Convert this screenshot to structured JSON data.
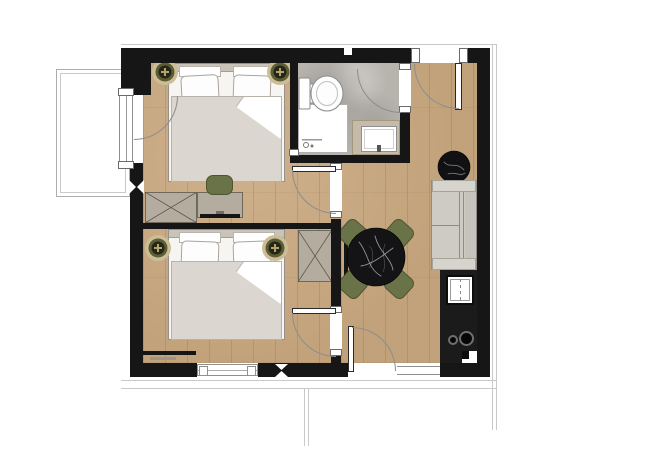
{
  "plan": {
    "kind": "apartment-floor-plan",
    "rooms": [
      {
        "name": "bedroom-1",
        "position": "top-left"
      },
      {
        "name": "bedroom-2",
        "position": "bottom-left"
      },
      {
        "name": "bathroom",
        "position": "top-center"
      },
      {
        "name": "living-kitchen",
        "position": "right"
      },
      {
        "name": "balcony",
        "position": "outside-left"
      }
    ],
    "fixtures": [
      {
        "icon": "double-bed-icon",
        "count": 2
      },
      {
        "icon": "nightstand-lamp-icon",
        "count": 4
      },
      {
        "icon": "wardrobe-x-icon",
        "count": 2
      },
      {
        "icon": "desk-icon",
        "count": 1
      },
      {
        "icon": "tv-icon",
        "count": 3
      },
      {
        "icon": "desk-chair-icon",
        "count": 1
      },
      {
        "icon": "toilet-icon",
        "count": 1
      },
      {
        "icon": "shower-icon",
        "count": 1
      },
      {
        "icon": "vanity-sink-icon",
        "count": 1
      },
      {
        "icon": "sofa-icon",
        "count": 1
      },
      {
        "icon": "kitchen-sink-icon",
        "count": 1
      },
      {
        "icon": "cooktop-icon",
        "count": 1
      },
      {
        "icon": "round-dining-table-icon",
        "count": 1
      },
      {
        "icon": "dining-chair-icon",
        "count": 4
      },
      {
        "icon": "side-table-icon",
        "count": 1
      },
      {
        "icon": "door-swing-arc",
        "count": 6
      },
      {
        "icon": "window",
        "count": 3
      }
    ],
    "palette": {
      "wall": "#161616",
      "wood": "#c9a87f",
      "bath_floor": "#b7b4ae",
      "furniture": "#b4ac9e",
      "furniture_border": "#6f685c",
      "sofa": "#cecbc4",
      "green": "#6a7347",
      "green_dark": "#4d5430",
      "marble": "#141417",
      "duvet": "#dbd7d0",
      "counter": "#1b1b1b",
      "vanity": "#c6bba8",
      "lamp_ring": "#cbbe97",
      "lamp_olive": "#5c5d33",
      "lamp_gold": "#b5a465",
      "arc": "#8d8d8d",
      "exterior_line": "#c9c9c9"
    }
  }
}
